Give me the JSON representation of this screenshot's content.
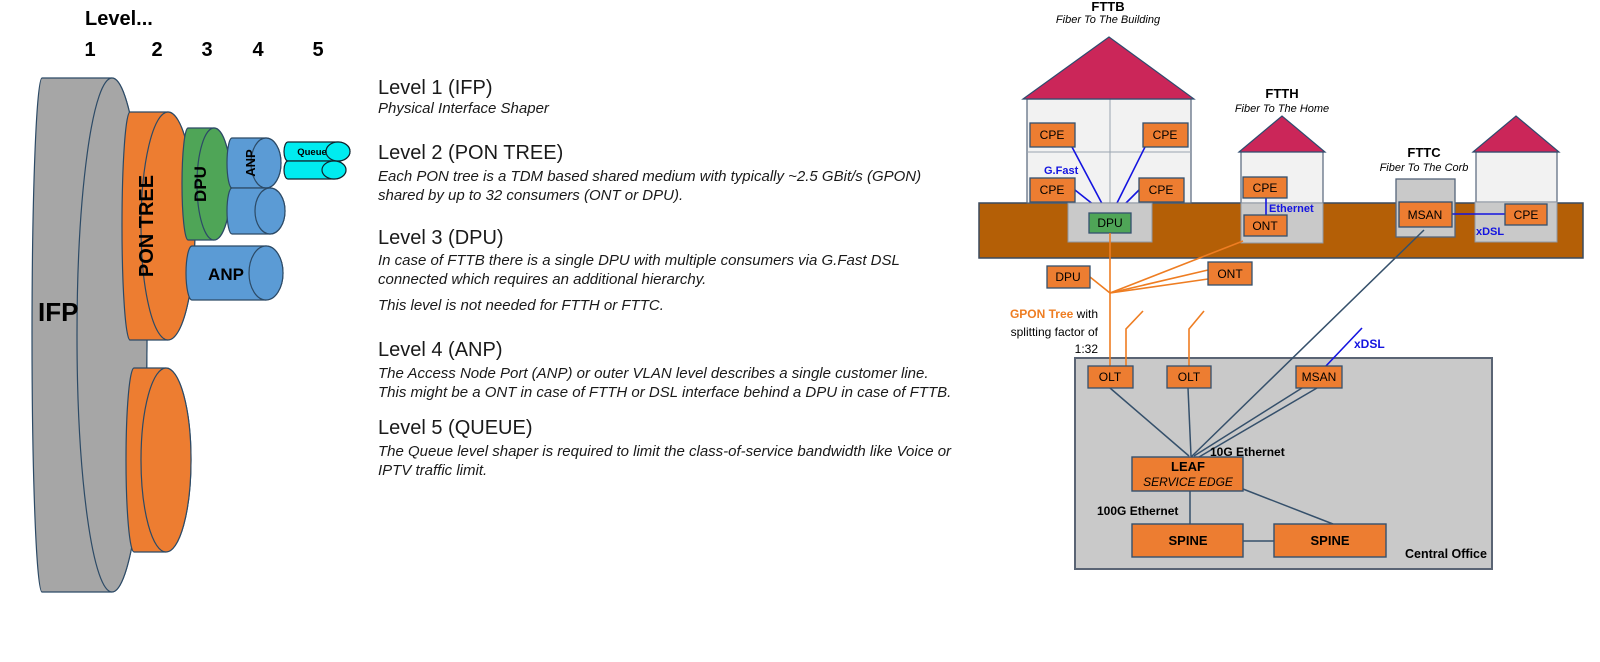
{
  "hdr": {
    "title": "Level...",
    "n1": "1",
    "n2": "2",
    "n3": "3",
    "n4": "4",
    "n5": "5"
  },
  "cyl": {
    "ifp": "IFP",
    "pon_tree": "PON TREE",
    "dpu": "DPU",
    "anp_top": "ANP",
    "queue": "Queue",
    "anp": "ANP"
  },
  "levels": {
    "l1": {
      "heading": "Level 1 (IFP)",
      "line1": "Physical Interface Shaper"
    },
    "l2": {
      "heading": "Level 2 (PON TREE)",
      "line1": "Each PON tree is a TDM based shared medium with typically ~2.5 GBit/s (GPON)",
      "line2": "shared by up to 32 consumers (ONT or DPU)."
    },
    "l3": {
      "heading": "Level 3 (DPU)",
      "line1": "In case of FTTB there is a single DPU with multiple consumers via G.Fast DSL",
      "line2": "connected which requires an additional hierarchy.",
      "note": "This level is not needed for FTTH or FTTC."
    },
    "l4": {
      "heading": "Level 4 (ANP)",
      "line1": "The Access Node Port (ANP) or outer VLAN level describes a single customer line.",
      "line2": "This might be a ONT in case of FTTH or DSL interface behind a DPU in case of FTTB."
    },
    "l5": {
      "heading": "Level 5 (QUEUE)",
      "line1": "The Queue level shaper is required to limit the class-of-service bandwidth like Voice or",
      "line2": "IPTV traffic limit."
    }
  },
  "net": {
    "fttb_title": "FTTB",
    "fttb_sub": "Fiber To The Building",
    "ftth_title": "FTTH",
    "ftth_sub": "Fiber To The Home",
    "fttc_title": "FTTC",
    "fttc_sub": "Fiber To The Corb",
    "cpe": "CPE",
    "dpu": "DPU",
    "ont": "ONT",
    "msan": "MSAN",
    "olt": "OLT",
    "gfast": "G.Fast",
    "ethernet": "Ethernet",
    "xdsl": "xDSL",
    "gpon_bold": "GPON Tree",
    "gpon_rest": " with",
    "gpon_line2": "splitting factor of",
    "gpon_line3": "1:32",
    "leaf": "LEAF",
    "service_edge": "SERVICE EDGE",
    "spine": "SPINE",
    "eth10": "10G Ethernet",
    "eth100": "100G Ethernet",
    "central_office": "Central Office"
  },
  "colors": {
    "orange": "#ED7D31",
    "green": "#4FA557",
    "blue_cyl": "#5B9BD5",
    "cyan": "#00ECF0",
    "gray_cyl": "#A6A6A6",
    "ground": "#B45F06",
    "roof": "#CB2659",
    "house": "#F2F2F2",
    "basement": "#C9C9C9",
    "central_office_fill": "#C9C9C9",
    "navy_line": "#35506B",
    "blue_line": "#1414E0",
    "orange_line": "#EE7D22"
  }
}
